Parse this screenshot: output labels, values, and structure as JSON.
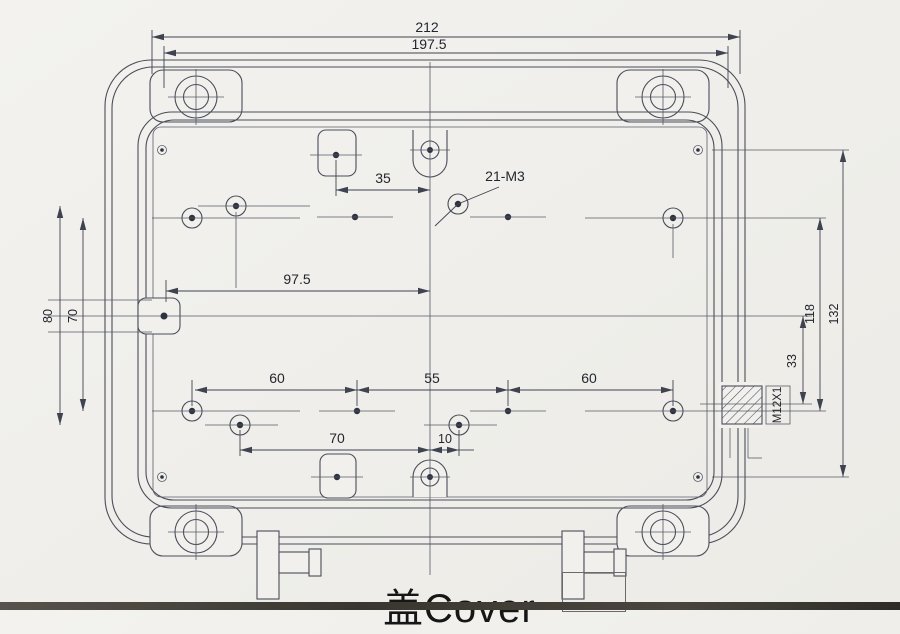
{
  "drawing": {
    "title": "盖Cover",
    "callouts": {
      "thread": "21-M3",
      "gland": "M12X1"
    },
    "dims": {
      "overall_width": "212",
      "inner_width": "197.5",
      "tab_offset": "35",
      "center_left": "97.5",
      "left_outer": "80",
      "left_inner": "70",
      "bottom_seg1": "60",
      "bottom_seg2": "55",
      "bottom_seg3": "60",
      "bottom_tab": "70",
      "bottom_offset": "10",
      "right_gland": "33",
      "right_inner": "118",
      "right_outer": "132"
    }
  }
}
